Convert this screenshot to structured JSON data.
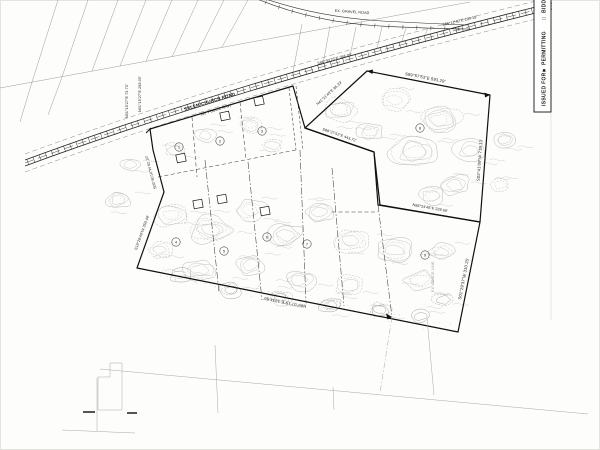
{
  "sheet": {
    "issued_for_label": "ISSUED FOR:",
    "option_1_checkbox": "■",
    "option_1": "PERMITTING",
    "option_2_checkbox": "□",
    "option_2": "BIDDING"
  },
  "road": {
    "name": "SALEM CHURCH ROAD",
    "row": "(60' PUBLIC R/W)",
    "gravel_label": "EX. GRAVEL ROAD",
    "bearing_left_1": "N01°15'27\"E 73.73'",
    "bearing_left_2": "N01°15'27\"E 298.00'",
    "bearing_mid": "S86°30'25\"E 386.05'",
    "bearing_right": "S85°12'40\"E 294.18'"
  },
  "boundary": {
    "tract_a_north": "S89°57'53\"E 593.29'",
    "tract_a_east": "S02°41'09\"W 718.13'",
    "tract_a_west": "N41°21'40\"E 86.33'",
    "tract_a_south": "N88°24'45\"E 229.60'",
    "inner_north": "S89°27'52\"E 443.72'",
    "east_lower": "S01°29'37\"W 310.25'",
    "south": "N89°07'15\"E 1334.56'",
    "west_upper": "S05°30'10\"W 62.10'",
    "west_lower": "S18°26'40\"W 350.48'"
  },
  "notes": {
    "fence": "EX. FENCE LINE"
  },
  "lots": [
    {
      "number": "1"
    },
    {
      "number": "2"
    },
    {
      "number": "3"
    },
    {
      "number": "4"
    },
    {
      "number": "5"
    },
    {
      "number": "6"
    },
    {
      "number": "7"
    },
    {
      "number": "8"
    },
    {
      "number": "9"
    }
  ]
}
